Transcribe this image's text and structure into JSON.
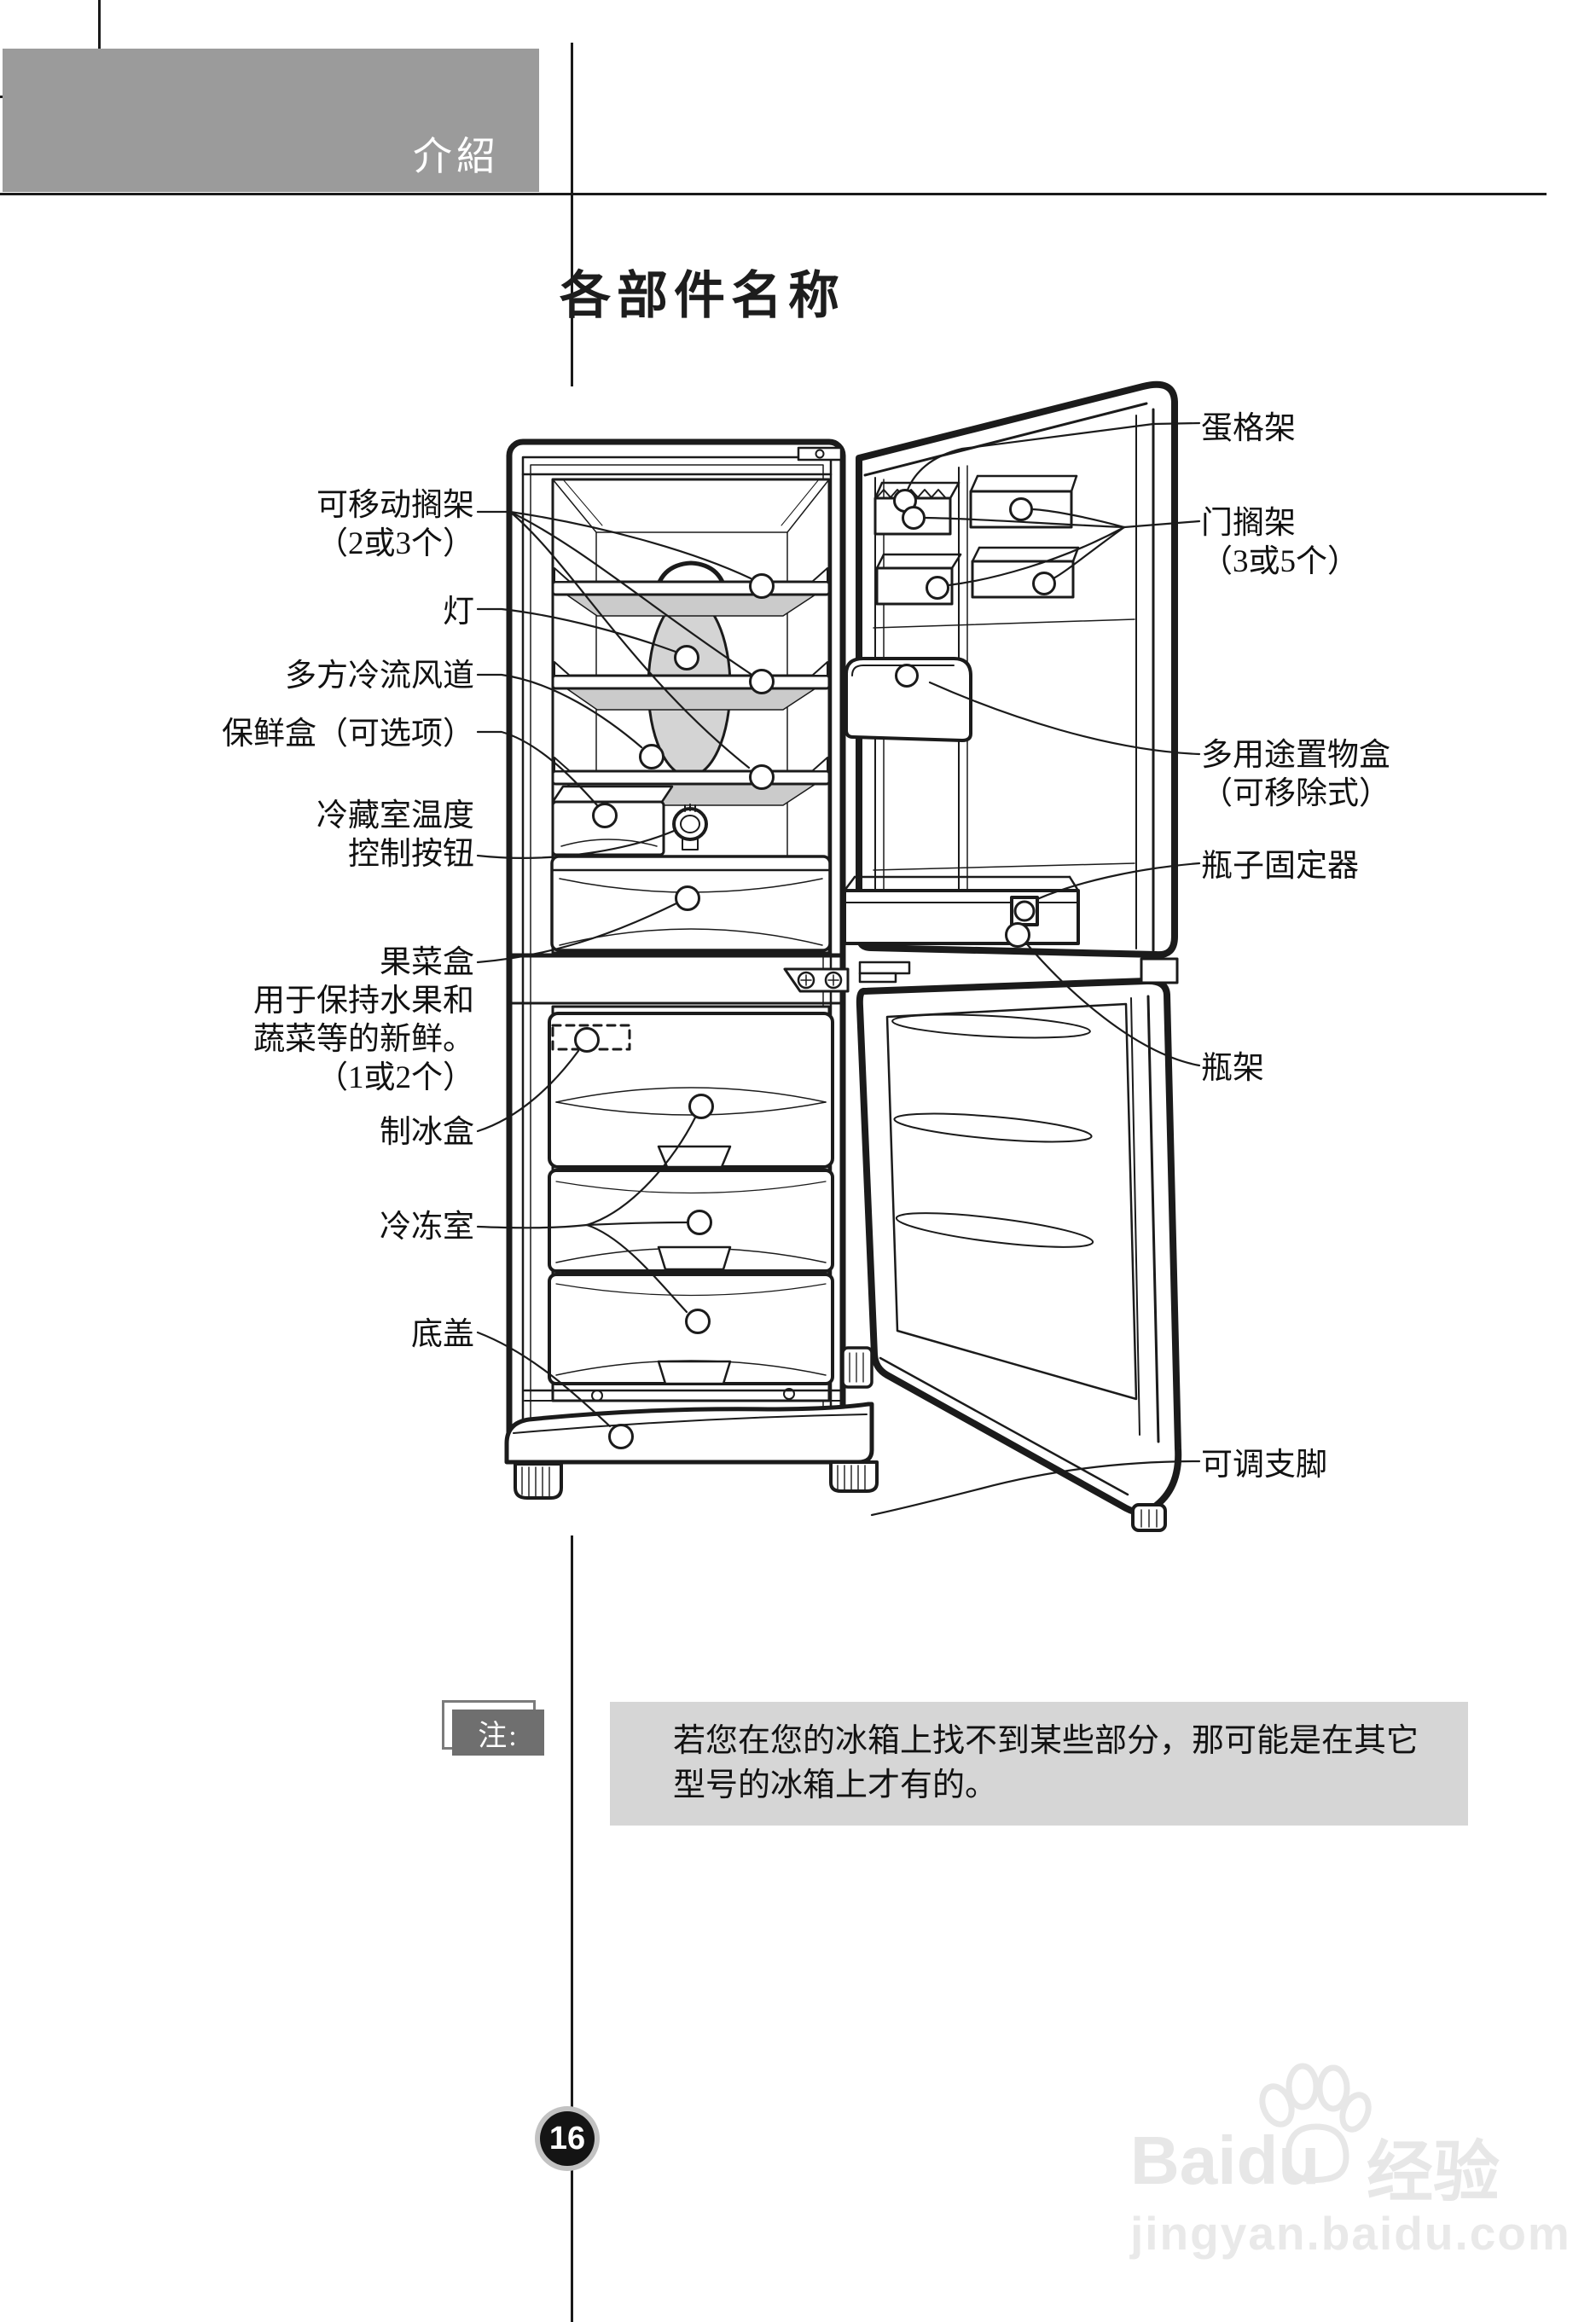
{
  "page": {
    "banner": {
      "label": "介紹"
    },
    "title": "各部件名称",
    "page_number": "16",
    "note": {
      "badge": "注:",
      "lines": [
        "若您在您的冰箱上找不到某些部分，那可能是在其它",
        "型号的冰箱上才有的。"
      ]
    },
    "watermark": {
      "brand": "Baidu",
      "brand_suffix": "经验",
      "url": "jingyan.baidu.com",
      "paw_icon": "baidu-paw-icon"
    },
    "colors": {
      "banner_bg": "#9b9b9b",
      "note_bg": "#d6d6d6",
      "note_badge_bg": "#6f6f6f",
      "line_art": "#1b1b1b",
      "shelf_glass_gray": "#cbcbcb",
      "duct_gray": "#d4d4d4",
      "page_circle_ring": "#c2c2c2",
      "watermark_gray": "#e7e7e7"
    }
  },
  "diagram": {
    "left_labels": [
      {
        "id": "removable-shelf",
        "lines": [
          "可移动搁架",
          "（2或3个）"
        ]
      },
      {
        "id": "lamp",
        "lines": [
          "灯"
        ]
      },
      {
        "id": "multi-air-flow-duct",
        "lines": [
          "多方冷流风道"
        ]
      },
      {
        "id": "fresh-box",
        "lines": [
          "保鲜盒（可选项）"
        ]
      },
      {
        "id": "fridge-temp-control",
        "lines": [
          "冷藏室温度",
          "控制按钮"
        ]
      },
      {
        "id": "fruit-veg-box",
        "lines": [
          "果菜盒",
          "用于保持水果和",
          "蔬菜等的新鲜。",
          "（1或2个）"
        ]
      },
      {
        "id": "ice-box",
        "lines": [
          "制冰盒"
        ]
      },
      {
        "id": "freezer-room",
        "lines": [
          "冷冻室"
        ]
      },
      {
        "id": "bottom-cover",
        "lines": [
          "底盖"
        ]
      }
    ],
    "right_labels": [
      {
        "id": "egg-rack",
        "lines": [
          "蛋格架"
        ]
      },
      {
        "id": "door-rack",
        "lines": [
          "门搁架",
          "（3或5个）"
        ]
      },
      {
        "id": "multi-purpose-box",
        "lines": [
          "多用途置物盒",
          "（可移除式）"
        ]
      },
      {
        "id": "bottle-fixer",
        "lines": [
          "瓶子固定器"
        ]
      },
      {
        "id": "bottle-rack",
        "lines": [
          "瓶架"
        ]
      },
      {
        "id": "adjustable-feet",
        "lines": [
          "可调支脚"
        ]
      }
    ]
  }
}
